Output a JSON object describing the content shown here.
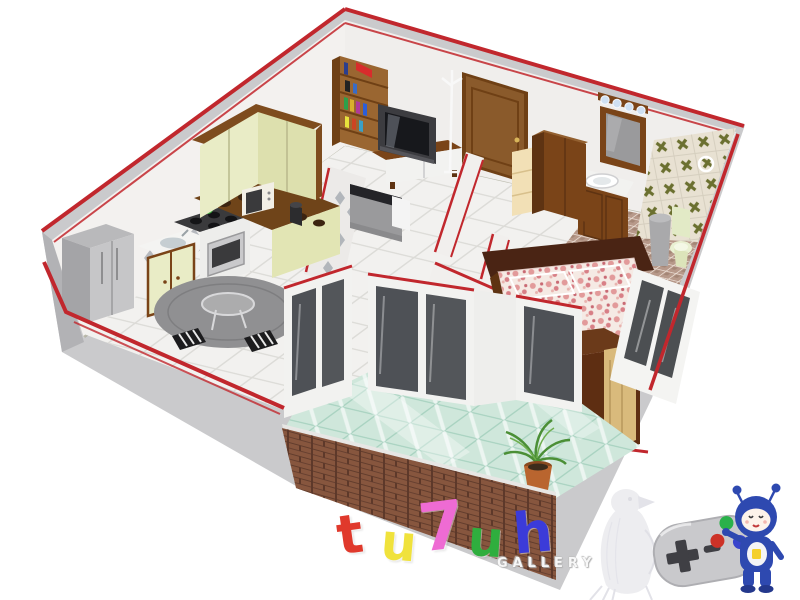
{
  "watermark": {
    "letters": [
      {
        "char": "t"
      },
      {
        "char": "u"
      },
      {
        "char": "7"
      },
      {
        "char": "u"
      },
      {
        "char": "h"
      }
    ],
    "subtitle": "GALLERY"
  },
  "colors": {
    "trim_red": "#c1272d",
    "wall_inner": "#f3f1ef",
    "wall_outer": "#cacacc",
    "wall_outer_dark": "#b2b2b5",
    "floor_tile": "#f2f1ef",
    "glass_floor": "#cfe7db",
    "brick": "#87563e",
    "wood": "#8a5a2b",
    "wood_mid": "#7a4418",
    "wood_dark": "#5e3312",
    "wood_deep": "#4a2414",
    "cream_cabinet": "#e9ecc6",
    "cream_cabinet_dark": "#dde0ae",
    "counter_brown": "#6f4419",
    "appliance_gray": "#c6c6c8",
    "bath_floor": "#b7998a",
    "bath_tile": "#e8e1d2",
    "tile_x_olive": "#6b7030",
    "bed_floral_pink": "#dd8289",
    "toilet_green": "#e2eac6",
    "pad_gray": "#c9c9cc",
    "pad_dark": "#3f3f44",
    "btn_green": "#2ab14a",
    "btn_red": "#cd3227",
    "btn_blue": "#3a45cc",
    "robot_blue": "#2e49b0",
    "plant_green": "#4b8f36",
    "pot_terracotta": "#b9652f",
    "wm1": "#e0392c",
    "wm2": "#f0e23c",
    "wm3": "#ee6bd3",
    "wm4": "#2fae3e",
    "wm5": "#3b3bd9"
  }
}
